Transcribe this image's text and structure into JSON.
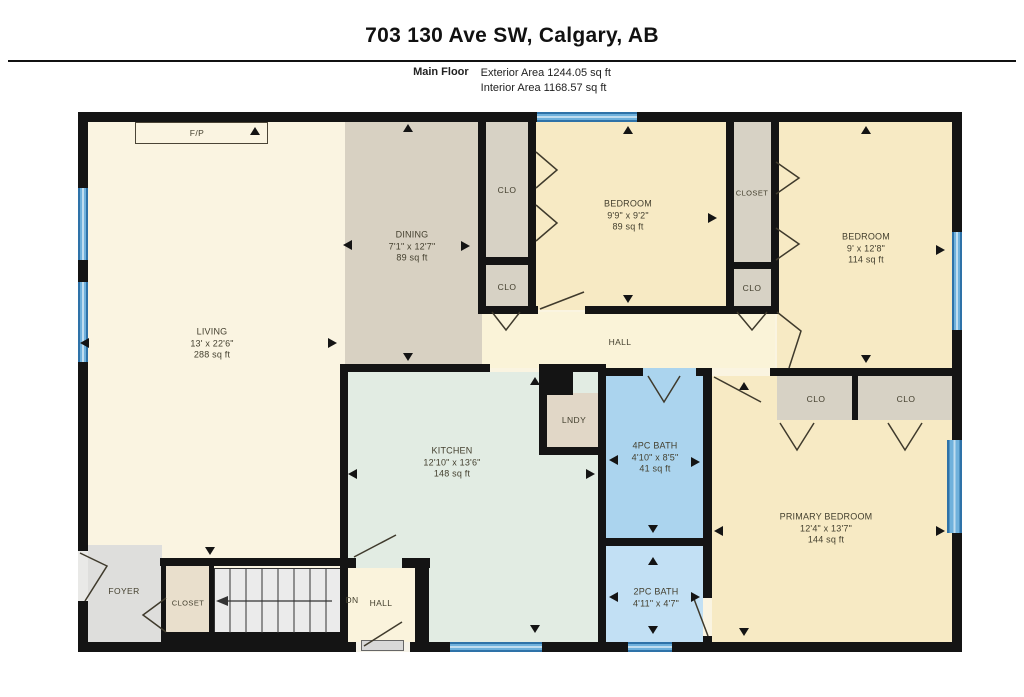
{
  "header": {
    "title": "703 130 Ave SW, Calgary, AB",
    "floor_label": "Main Floor",
    "exterior_area": "Exterior Area 1244.05 sq ft",
    "interior_area": "Interior Area 1168.57 sq ft"
  },
  "rooms": {
    "living": {
      "name": "LIVING",
      "dims": "13' x 22'6\"",
      "area": "288 sq ft"
    },
    "dining": {
      "name": "DINING",
      "dims": "7'1\" x 12'7\"",
      "area": "89 sq ft"
    },
    "bedroom_middle": {
      "name": "BEDROOM",
      "dims": "9'9\" x 9'2\"",
      "area": "89 sq ft"
    },
    "bedroom_right": {
      "name": "BEDROOM",
      "dims": "9' x 12'8\"",
      "area": "114 sq ft"
    },
    "kitchen": {
      "name": "KITCHEN",
      "dims": "12'10\" x 13'6\"",
      "area": "148 sq ft"
    },
    "bath_4pc": {
      "name": "4PC BATH",
      "dims": "4'10\" x 8'5\"",
      "area": "41 sq ft"
    },
    "bath_2pc": {
      "name": "2PC BATH",
      "dims": "4'11\" x 4'7\""
    },
    "primary_bedroom": {
      "name": "PRIMARY BEDROOM",
      "dims": "12'4\" x 13'7\"",
      "area": "144 sq ft"
    }
  },
  "labels": {
    "hall": "HALL",
    "lndy": "LNDY",
    "foyer": "FOYER",
    "closet": "CLOSET",
    "clo": "CLO",
    "dn": "DN",
    "fp": "F/P"
  },
  "colors": {
    "wall": "#141414",
    "window_blue": "#4D9BD1",
    "living_cream": "#FAF4E1",
    "bedroom_yellow": "#F7EAC4",
    "dining_tan": "#D8D1C2",
    "closet_tan": "#D7D2C5",
    "kitchen_mint": "#E2ECE3",
    "bath_blue": "#ABD4EE",
    "bath_light_blue": "#C2E0F4",
    "hall_cream": "#FAF3D8",
    "laundry_tan": "#E1D7C7",
    "foyer_gray": "#DEDEDC"
  }
}
